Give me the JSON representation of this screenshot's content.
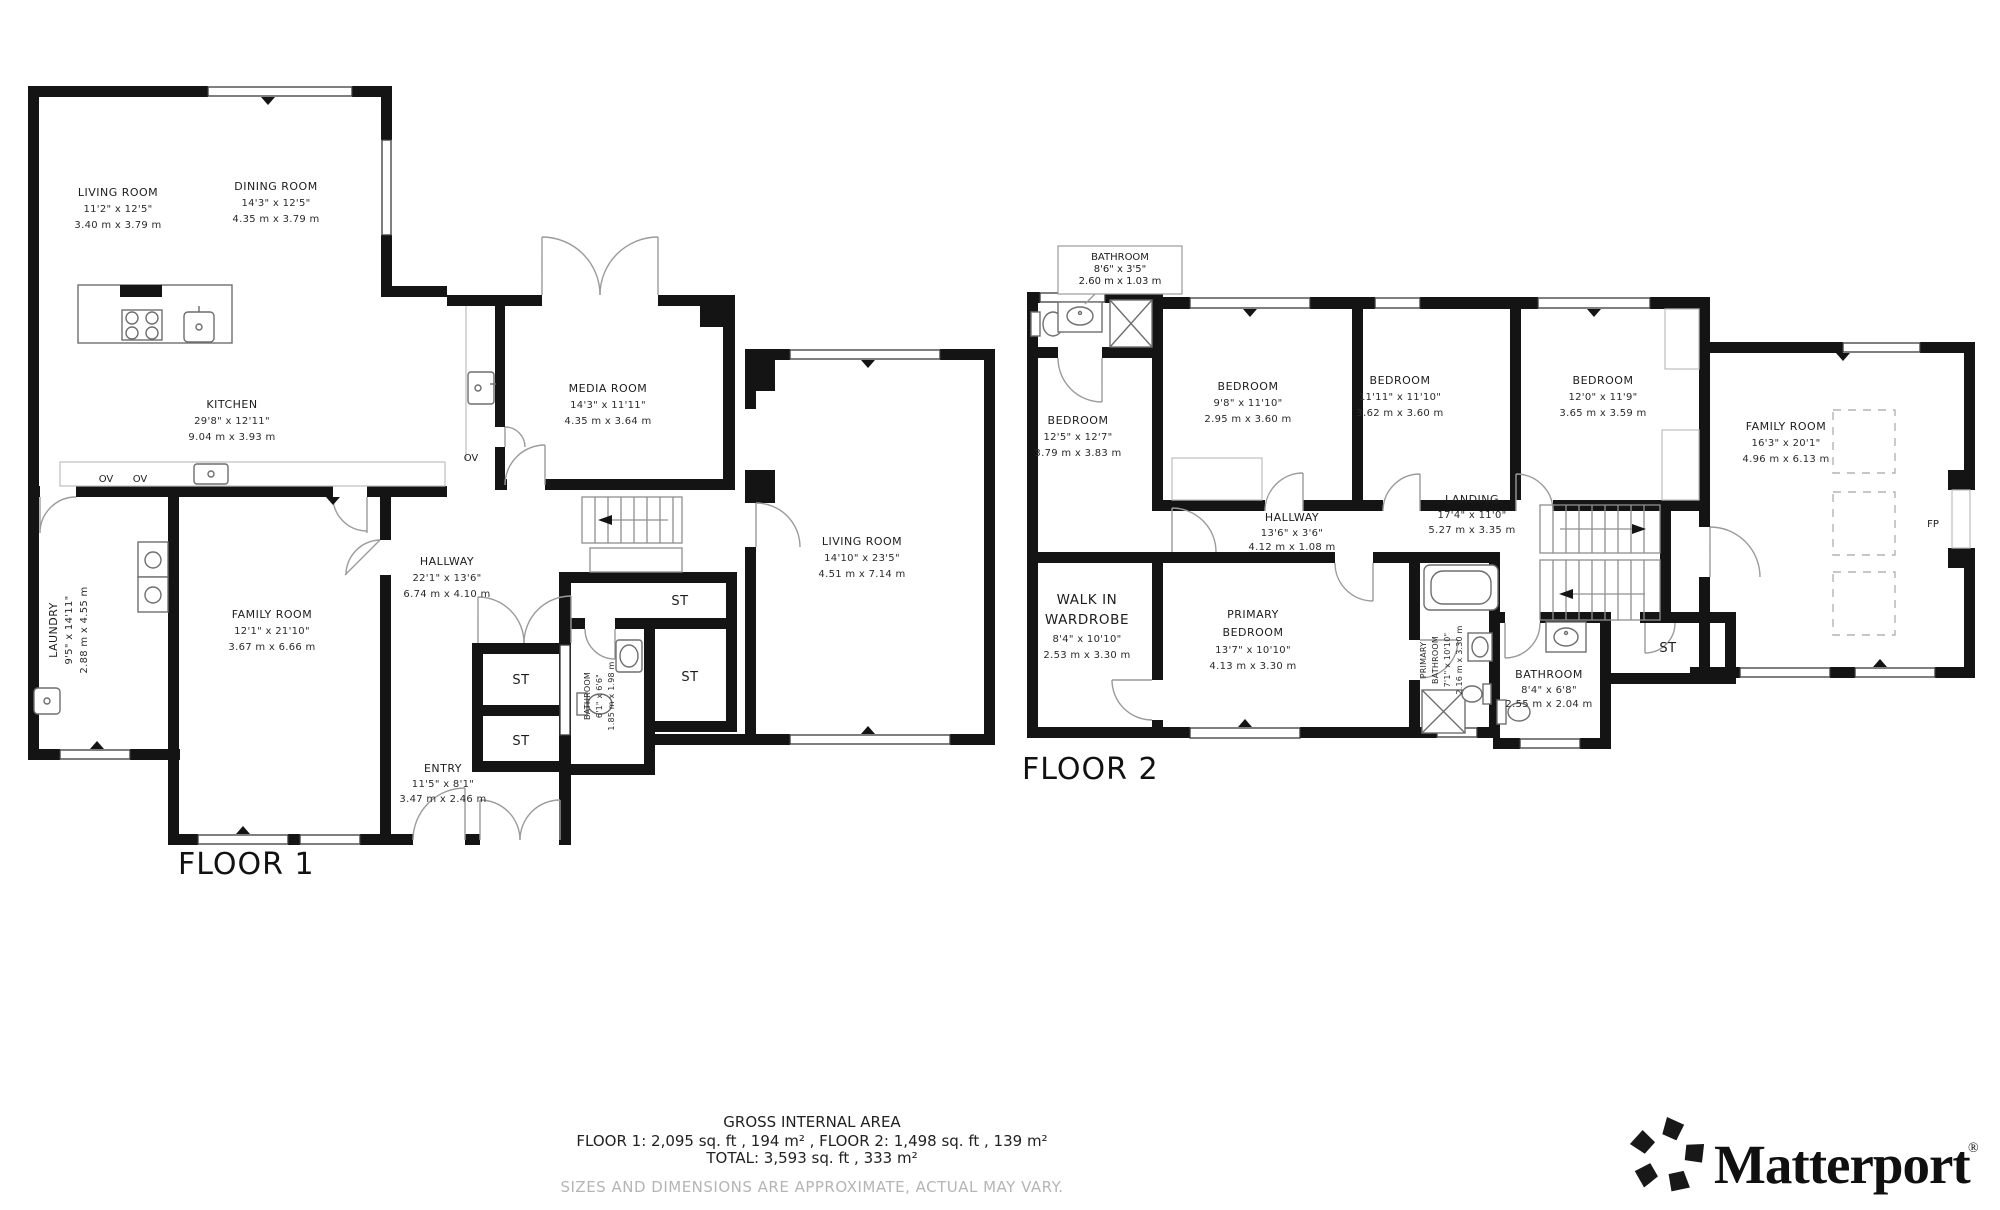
{
  "floor1": {
    "label": "FLOOR 1",
    "rooms": {
      "living_room": {
        "name": "LIVING ROOM",
        "imperial": "11'2\" x 12'5\"",
        "metric": "3.40 m x 3.79 m"
      },
      "dining_room": {
        "name": "DINING ROOM",
        "imperial": "14'3\" x 12'5\"",
        "metric": "4.35 m x 3.79 m"
      },
      "kitchen": {
        "name": "KITCHEN",
        "imperial": "29'8\" x 12'11\"",
        "metric": "9.04 m x 3.93 m"
      },
      "media_room": {
        "name": "MEDIA ROOM",
        "imperial": "14'3\" x 11'11\"",
        "metric": "4.35 m x 3.64 m"
      },
      "living_room_2": {
        "name": "LIVING ROOM",
        "imperial": "14'10\" x 23'5\"",
        "metric": "4.51 m x 7.14 m"
      },
      "laundry": {
        "name": "LAUNDRY",
        "imperial": "9'5\" x 14'11\"",
        "metric": "2.88 m x 4.55 m"
      },
      "family_room": {
        "name": "FAMILY ROOM",
        "imperial": "12'1\" x 21'10\"",
        "metric": "3.67 m x 6.66 m"
      },
      "hallway": {
        "name": "HALLWAY",
        "imperial": "22'1\" x 13'6\"",
        "metric": "6.74 m x 4.10 m"
      },
      "entry": {
        "name": "ENTRY",
        "imperial": "11'5\" x 8'1\"",
        "metric": "3.47 m x 2.46 m"
      },
      "bathroom": {
        "name": "BATHROOM",
        "imperial": "6'1\" x 6'6\"",
        "metric": "1.85 m x 1.98 m"
      }
    },
    "tags": {
      "st": "ST",
      "ov": "OV"
    }
  },
  "floor2": {
    "label": "FLOOR 2",
    "rooms": {
      "bathroom_callout": {
        "name": "BATHROOM",
        "imperial": "8'6\" x 3'5\"",
        "metric": "2.60 m x 1.03 m"
      },
      "bedroom_1": {
        "name": "BEDROOM",
        "imperial": "12'5\" x 12'7\"",
        "metric": "3.79 m x 3.83 m"
      },
      "bedroom_2": {
        "name": "BEDROOM",
        "imperial": "9'8\" x 11'10\"",
        "metric": "2.95 m x 3.60 m"
      },
      "bedroom_3": {
        "name": "BEDROOM",
        "imperial": "11'11\" x 11'10\"",
        "metric": "3.62 m x 3.60 m"
      },
      "bedroom_4": {
        "name": "BEDROOM",
        "imperial": "12'0\" x 11'9\"",
        "metric": "3.65 m x 3.59 m"
      },
      "family_room": {
        "name": "FAMILY ROOM",
        "imperial": "16'3\" x 20'1\"",
        "metric": "4.96 m x 6.13 m"
      },
      "landing": {
        "name": "LANDING",
        "imperial": "17'4\" x 11'0\"",
        "metric": "5.27 m x 3.35 m"
      },
      "hallway": {
        "name": "HALLWAY",
        "imperial": "13'6\" x 3'6\"",
        "metric": "4.12 m x 1.08 m"
      },
      "walk_in_wardrobe": {
        "name_line1": "WALK IN",
        "name_line2": "WARDROBE",
        "imperial": "8'4\" x 10'10\"",
        "metric": "2.53 m x 3.30 m"
      },
      "primary_bedroom": {
        "name_line1": "PRIMARY",
        "name_line2": "BEDROOM",
        "imperial": "13'7\" x 10'10\"",
        "metric": "4.13 m x 3.30 m"
      },
      "primary_bathroom": {
        "name_line1": "PRIMARY",
        "name_line2": "BATHROOM",
        "imperial": "7'1\" x 10'10\"",
        "metric": "2.16 m x 3.30 m"
      },
      "bathroom": {
        "name": "BATHROOM",
        "imperial": "8'4\" x 6'8\"",
        "metric": "2.55 m x 2.04 m"
      }
    },
    "tags": {
      "st": "ST",
      "fp": "FP"
    }
  },
  "footer": {
    "title": "GROSS INTERNAL AREA",
    "line1": "FLOOR 1: 2,095 sq. ft , 194 m² , FLOOR 2: 1,498 sq. ft , 139 m²",
    "line2": "TOTAL: 3,593 sq. ft , 333 m²",
    "disclaimer": "SIZES AND DIMENSIONS ARE APPROXIMATE, ACTUAL MAY VARY."
  },
  "brand": {
    "name": "Matterport",
    "registered": "®"
  }
}
